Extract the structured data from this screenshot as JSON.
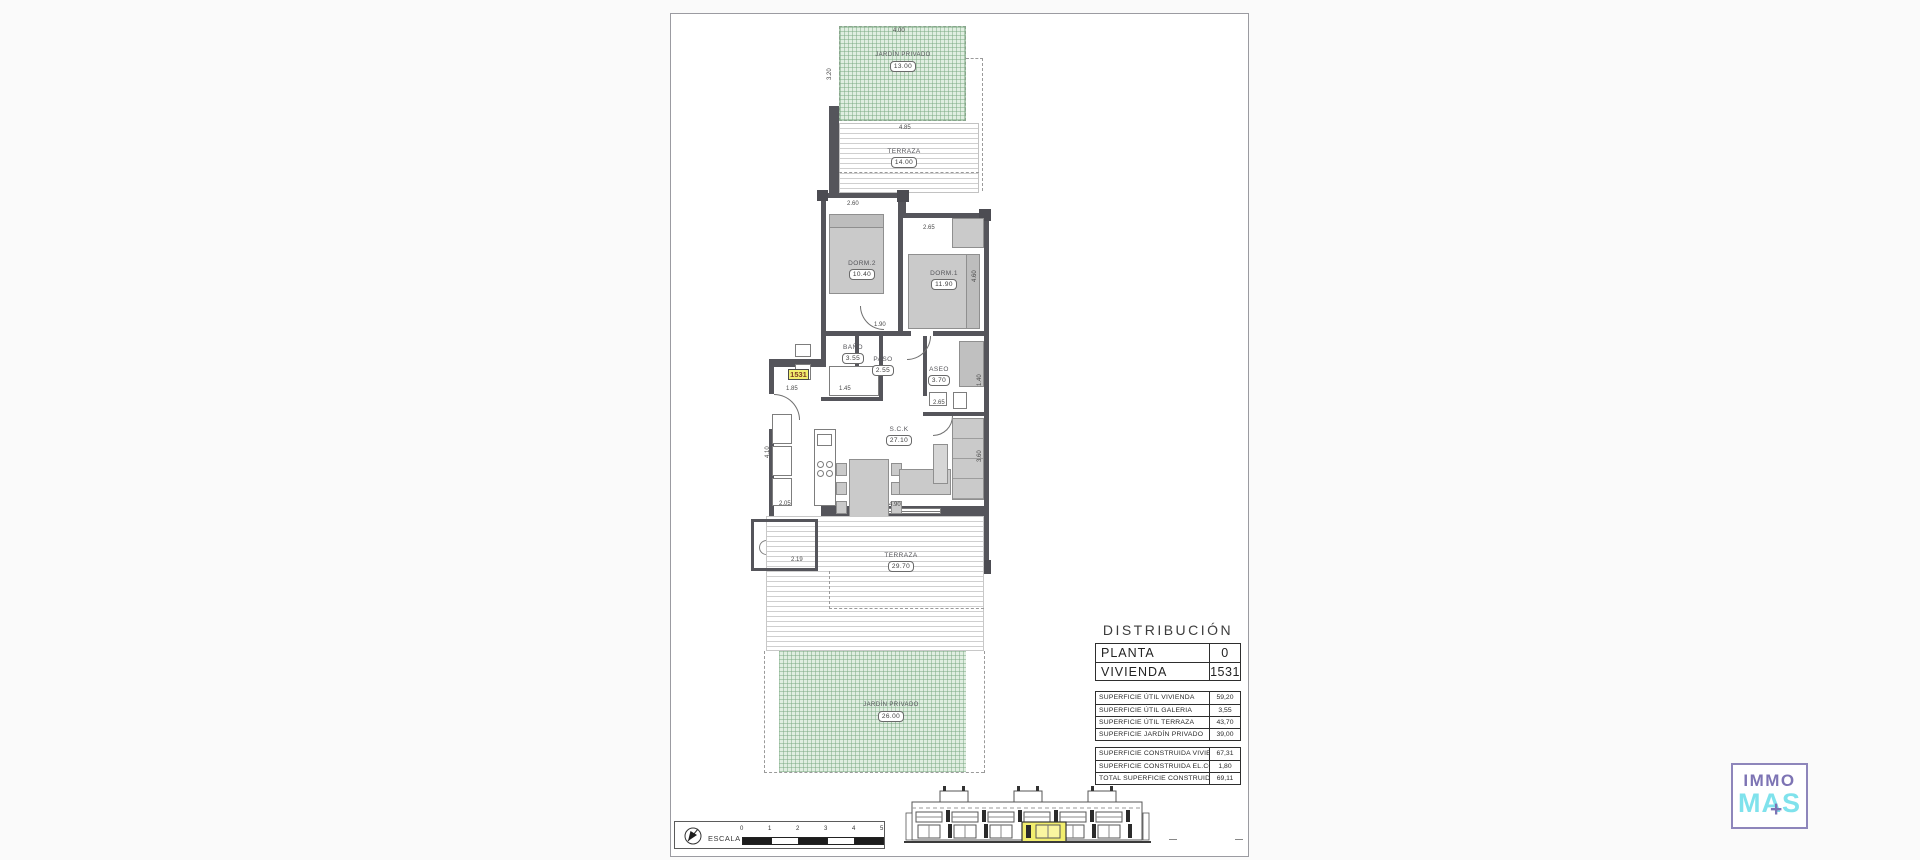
{
  "plan": {
    "unit_badge": "1531",
    "rooms": {
      "jardin_top": {
        "name": "JARDÍN PRIVADO",
        "area": "13.00"
      },
      "terraza_top": {
        "name": "TERRAZA",
        "area": "14.00"
      },
      "dorm2": {
        "name": "DORM.2",
        "area": "10.40"
      },
      "dorm1": {
        "name": "DORM.1",
        "area": "11.90"
      },
      "bano": {
        "name": "BAÑO",
        "area": "3.55"
      },
      "paso": {
        "name": "PASO",
        "area": "2.55"
      },
      "aseo": {
        "name": "ASEO",
        "area": "3.70"
      },
      "sck": {
        "name": "S.C.K",
        "area": "27.10"
      },
      "galeria": {
        "name": "GALERIA",
        "area": "3.55"
      },
      "terraza_main": {
        "name": "TERRAZA",
        "area": "29.70"
      },
      "jardin_bottom": {
        "name": "JARDÍN PRIVADO",
        "area": "26.00"
      }
    },
    "dims": [
      "4.00",
      "3.20",
      "4.85",
      "2.60",
      "2.65",
      "1.90",
      "4.60",
      "1.85",
      "1.45",
      "2.65",
      "1.40",
      "3.60",
      "4.90",
      "2.05",
      "2.19",
      "4.10"
    ]
  },
  "distribution": {
    "title": "DISTRIBUCIÓN",
    "main_rows": [
      {
        "label": "PLANTA",
        "value": "0"
      },
      {
        "label": "VIVIENDA",
        "value": "1531"
      }
    ],
    "util_rows": [
      {
        "label": "SUPERFICIE ÚTIL VIVIENDA",
        "value": "59,20"
      },
      {
        "label": "SUPERFICIE ÚTIL GALERIA",
        "value": "3,55"
      },
      {
        "label": "SUPERFICIE ÚTIL TERRAZA",
        "value": "43,70"
      },
      {
        "label": "SUPERFICIE JARDÍN PRIVADO",
        "value": "39,00"
      }
    ],
    "built_rows": [
      {
        "label": "SUPERFICIE CONSTRUIDA VIVIENDA",
        "value": "67,31"
      },
      {
        "label": "SUPERFICIE CONSTRUIDA EL.COMUNES",
        "value": "1,80"
      },
      {
        "label": "TOTAL SUPERFICIE CONSTRUIDA",
        "value": "69,11"
      }
    ]
  },
  "scalebar": {
    "label": "ESCALA :",
    "ticks": [
      "0",
      "1",
      "2",
      "3",
      "4",
      "5"
    ]
  },
  "logo": {
    "line1": "IMMO",
    "line2": "MAS",
    "plus": "+"
  }
}
